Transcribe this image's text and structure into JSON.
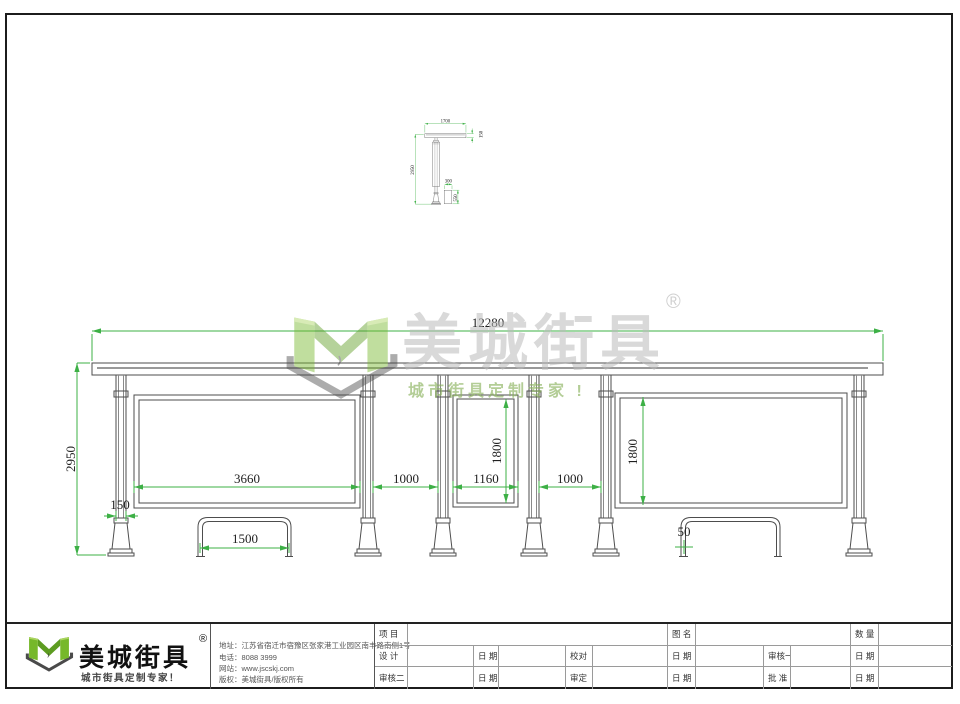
{
  "watermark": {
    "brand": "美城街具",
    "reg": "®",
    "slogan": "城市街具定制专家 !"
  },
  "side_view": {
    "dims": {
      "width": "1700",
      "roof_thickness": "150",
      "height": "2950",
      "bin_width": "300",
      "bin_height": "550"
    }
  },
  "front_view": {
    "dims": {
      "total_width": "12280",
      "height": "2950",
      "left_panel": "3660",
      "gap_left": "1000",
      "mid_panel": "1160",
      "gap_right": "1000",
      "mid_panel_height": "1800",
      "right_panel_height": "1800",
      "column_width": "150",
      "bench_width": "1500",
      "tube": "50"
    }
  },
  "title_block": {
    "logo": {
      "brand": "美城街具",
      "reg": "®",
      "slogan": "城市街具定制专家！"
    },
    "company": {
      "address": "地址：江苏省宿迁市宿豫区张家港工业园区南丰路南侧1号",
      "phone": "电话：8088 3999",
      "web": "网站：www.jscskj.com",
      "copyright": "版权：美城街具/版权所有"
    },
    "table": {
      "project": "项 目",
      "drawing_name": "图 名",
      "quantity": "数 量",
      "design": "设 计",
      "date": "日 期",
      "proof": "校对",
      "review1": "审核一",
      "review2": "审核二",
      "approve": "审定",
      "ratify": "批 准"
    }
  },
  "colors": {
    "dimension": "#3db046",
    "line": "#4d4d4d",
    "logo_green": "#76b82a"
  }
}
